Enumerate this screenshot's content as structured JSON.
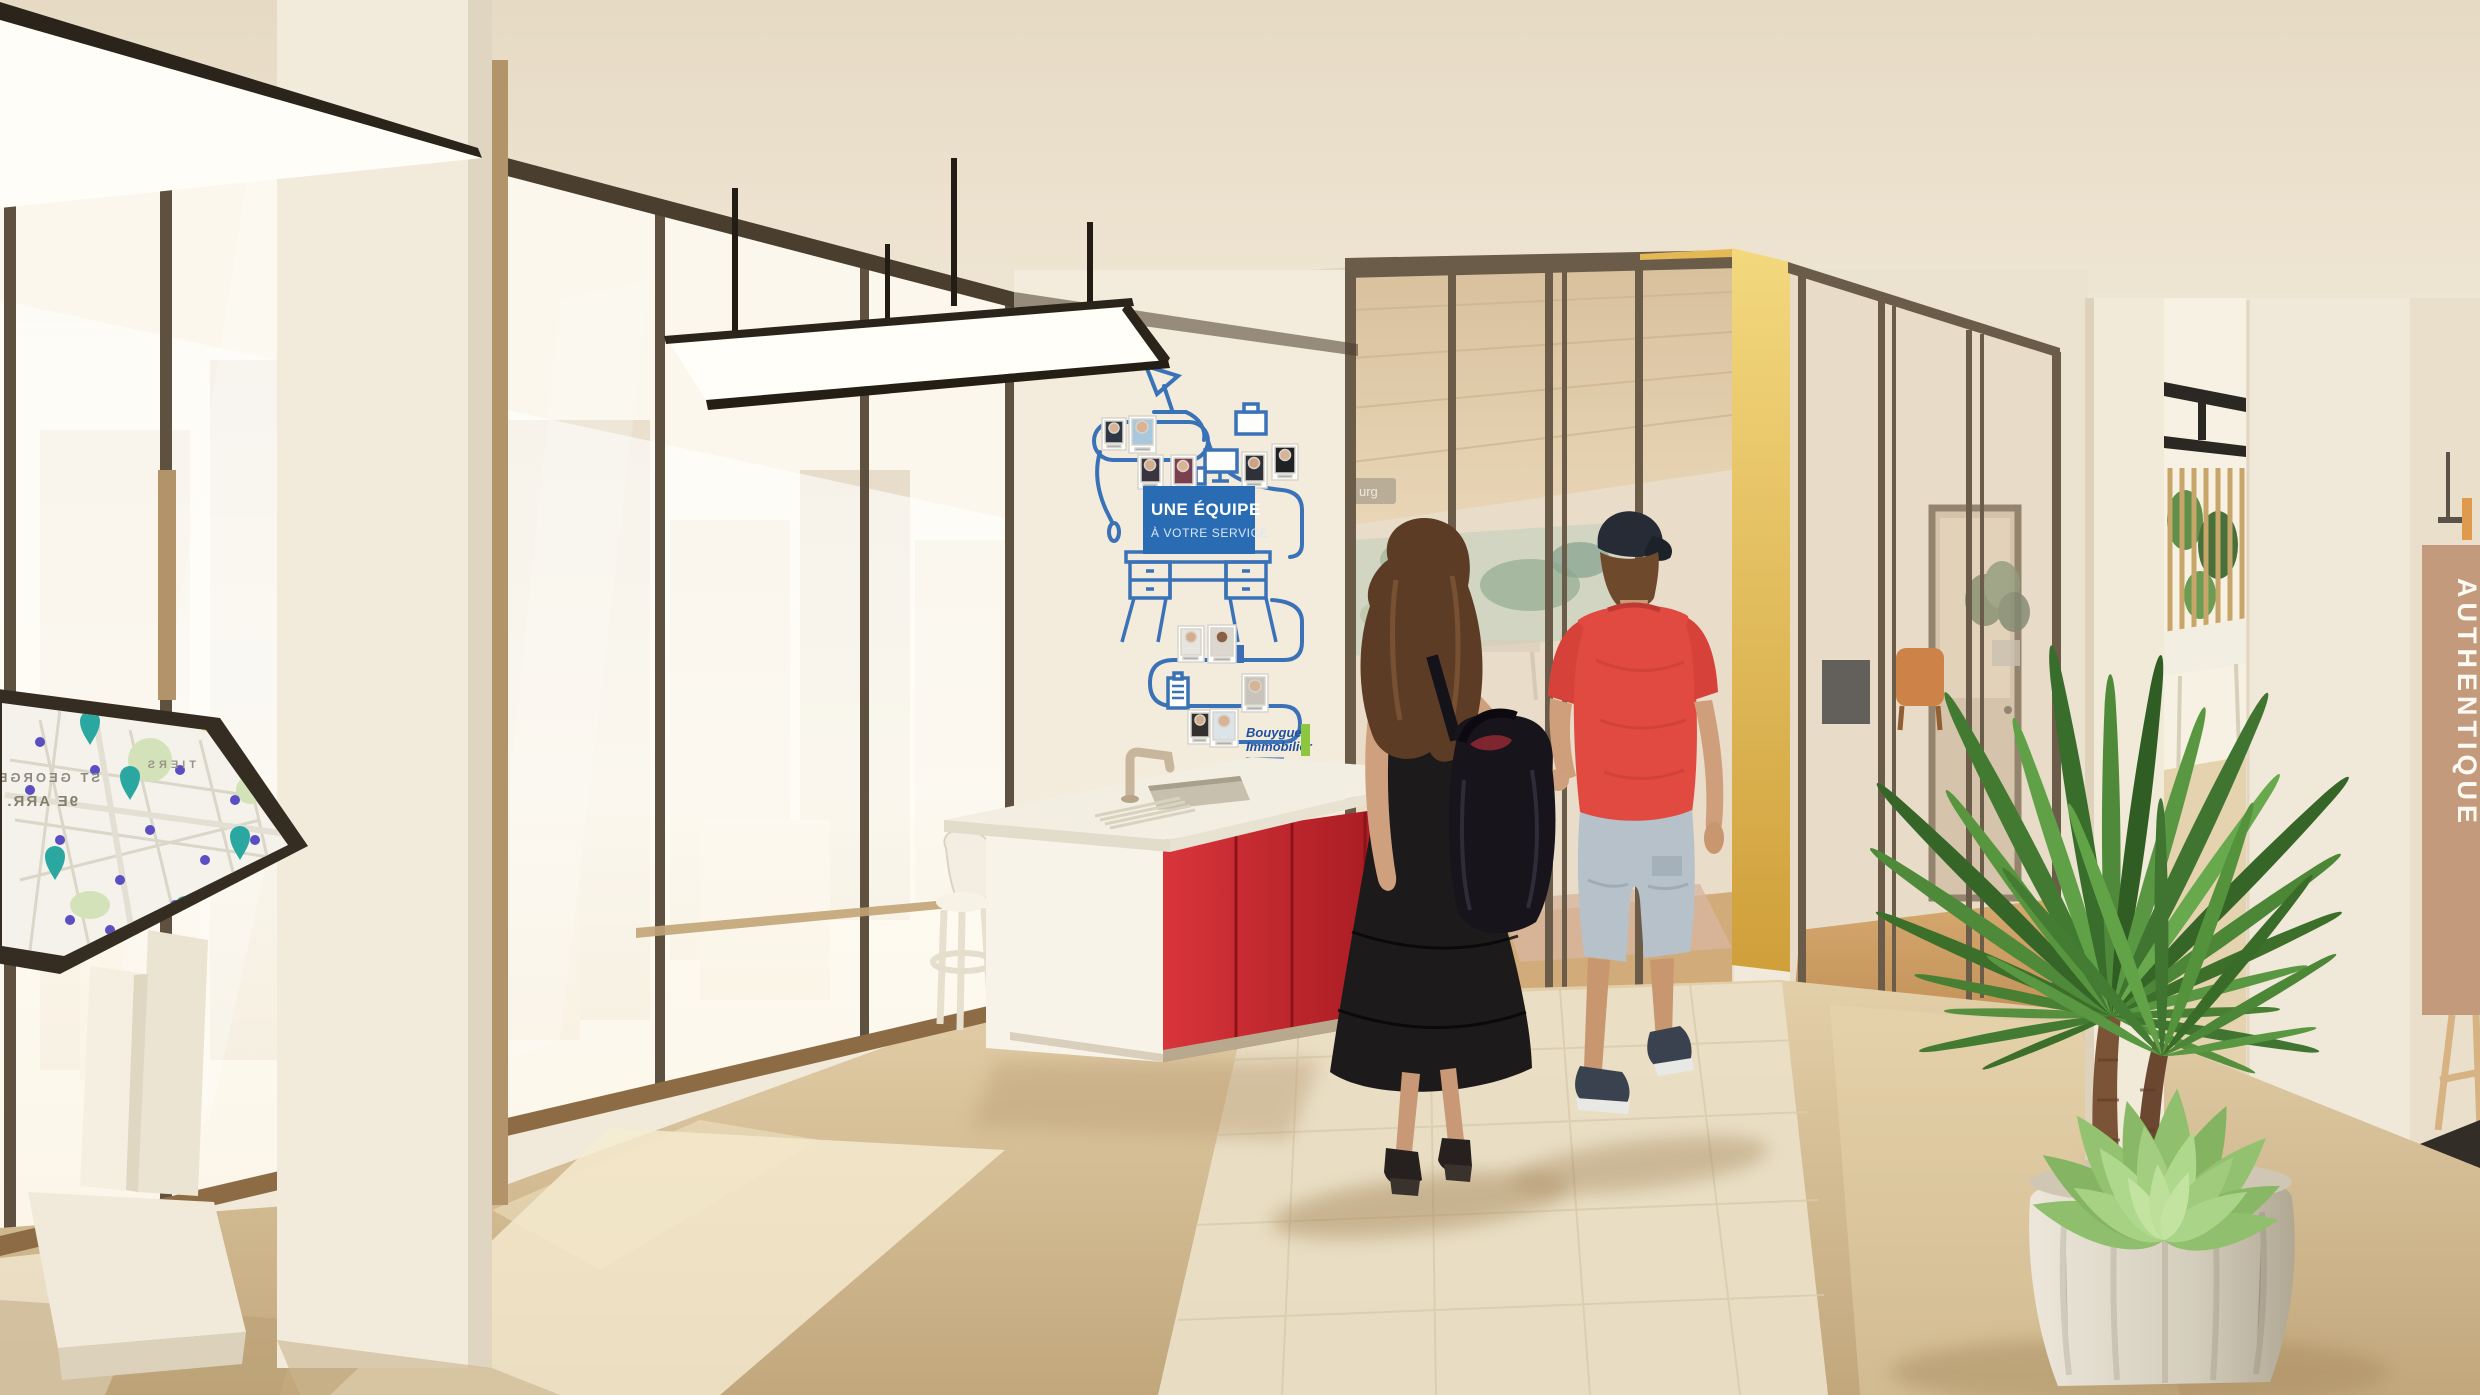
{
  "decal": {
    "sign_line1": "UNE ÉQUIPE",
    "sign_line2": "À VOTRE SERVICE",
    "logo_line1": "Bouygues",
    "logo_line2": "Immobilier"
  },
  "map": {
    "district": "ST GEORGES",
    "arrondissement": "9E ARR.",
    "area": "TIERS"
  },
  "right_wall": {
    "banner": "AUTHENTIQUE"
  },
  "meeting_room": {
    "plate": "urg"
  },
  "colors": {
    "accent_red": "#c0272d",
    "decal_blue": "#2a6cb4",
    "logo_green": "#8dc63f",
    "partition_yellow": "#e5ba4d",
    "frame_bronze": "#6b5c49",
    "plant_green": "#4f8a3a",
    "floor_beige": "#d3bd96"
  }
}
